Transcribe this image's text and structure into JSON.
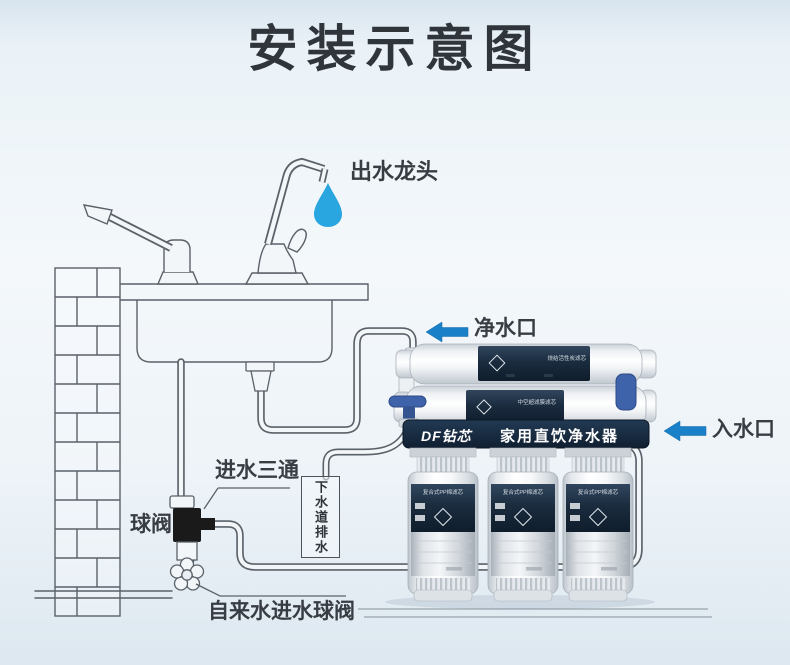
{
  "title": "安装示意图",
  "labels": {
    "outlet_faucet": "出水龙头",
    "pure_water_port": "净水口",
    "water_inlet_port": "入水口",
    "inlet_tee": "进水三通",
    "ball_valve": "球阀",
    "sewer_drain": "下水道排水",
    "tap_water_inlet_valve": "自来水进水球阀"
  },
  "device": {
    "brand": "DF钻芯",
    "product_name": "家用直饮净水器",
    "h_filter_1_text": "烧结活性炭滤芯",
    "h_filter_2_text": "中空超滤膜滤芯",
    "v_filter_text": "复合式PP棉滤芯"
  },
  "colors": {
    "arrow_blue": "#1a80c8",
    "drop_blue": "#29a5e0",
    "band_navy": "#14243a",
    "filter_label_navy": "#1b2c3f",
    "valve_blue": "#3f63ab",
    "line_gray": "#5b6169",
    "text_dark": "#383d44",
    "background": "#eef4f9"
  }
}
